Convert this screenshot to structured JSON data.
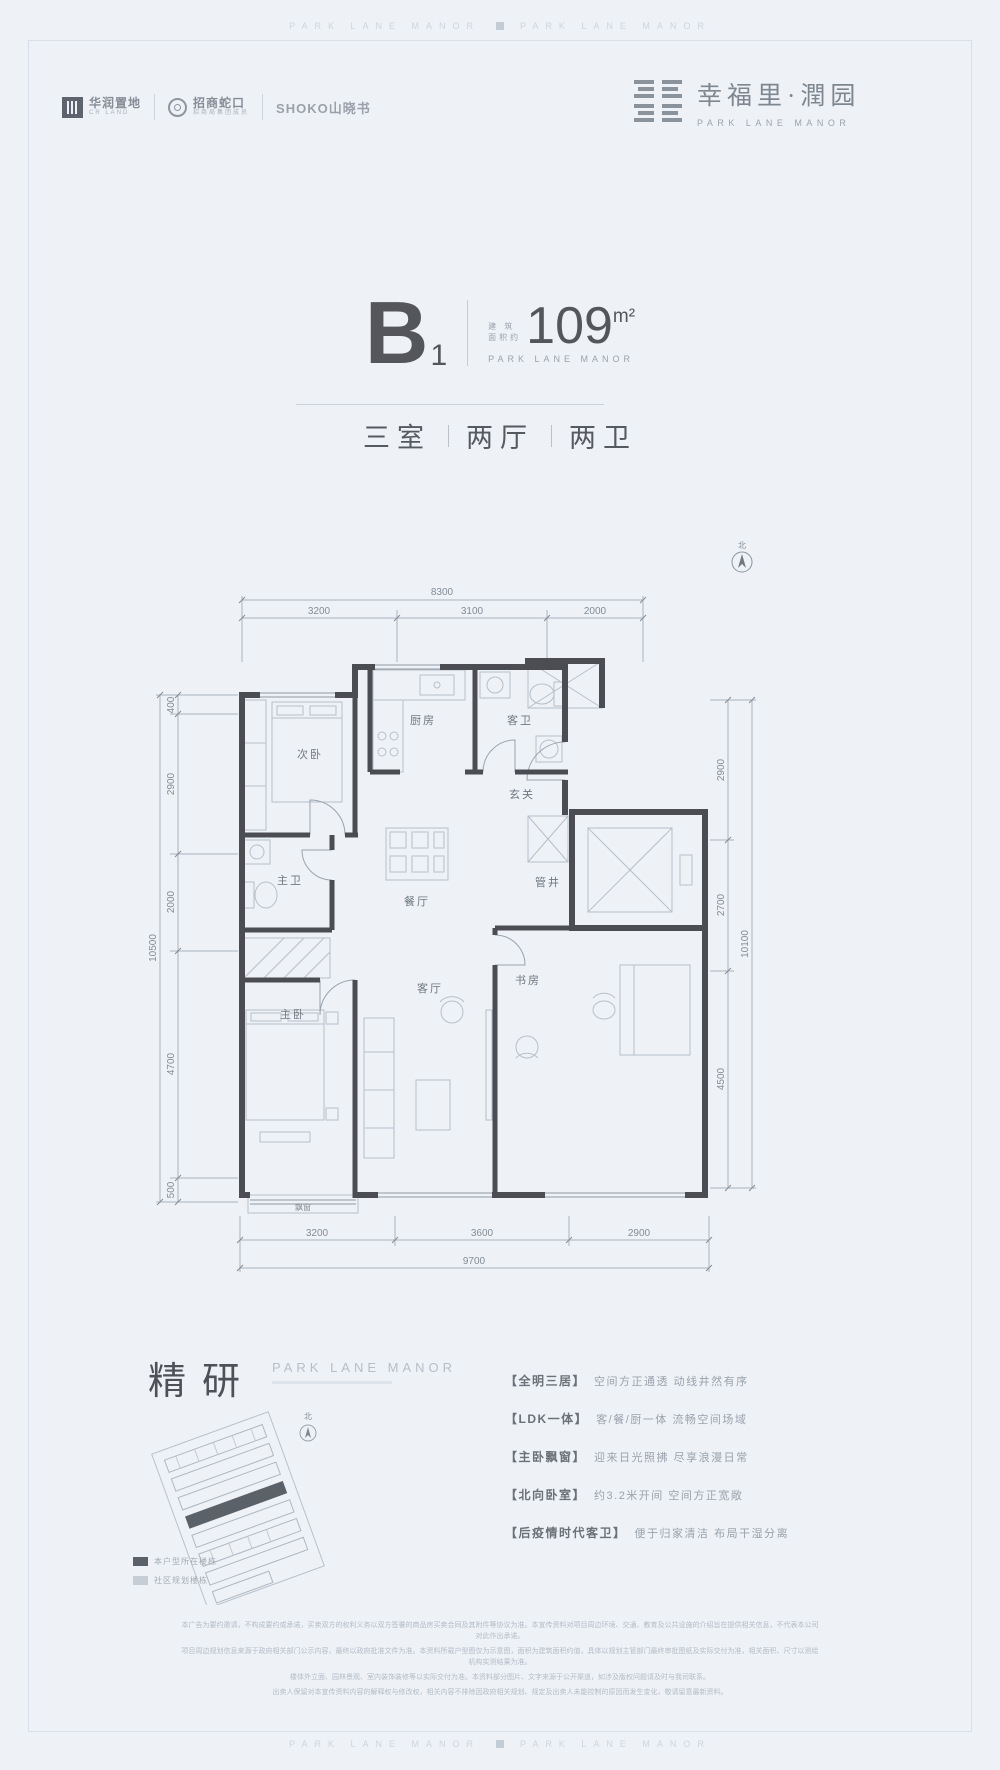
{
  "watermark": {
    "text_left": "PARK LANE MANOR",
    "text_right": "PARK LANE MANOR"
  },
  "header": {
    "logos": [
      {
        "cn": "华润置地",
        "en": "CR LAND"
      },
      {
        "cn": "招商蛇口",
        "en": "招商局集团成员"
      },
      {
        "cn": "SHOKO山晓书"
      }
    ],
    "brand": {
      "cn": "幸福里·潤园",
      "en": "PARK LANE MANOR"
    }
  },
  "unit": {
    "code": "B",
    "code_sub": "1",
    "area_label_l1": "建 筑",
    "area_label_l2": "面积约",
    "area_value": "109",
    "area_unit": "m²",
    "brand_en": "PARK LANE MANOR",
    "layout": {
      "rooms": "三室",
      "halls": "两厅",
      "baths": "两卫"
    }
  },
  "floorplan": {
    "north_label": "北",
    "dims": {
      "top_total": "8300",
      "top": [
        "3200",
        "3100",
        "2000"
      ],
      "left_total": "10500",
      "left": [
        "400",
        "2900",
        "2000",
        "4700",
        "500"
      ],
      "right_total": "10100",
      "right": [
        "2900",
        "2700",
        "4500"
      ],
      "bottom_total": "9700",
      "bottom": [
        "3200",
        "3600",
        "2900"
      ]
    },
    "rooms": {
      "second_bedroom": "次卧",
      "kitchen": "厨房",
      "guest_bath": "客卫",
      "foyer": "玄关",
      "shaft": "管井",
      "master_bath": "主卫",
      "dining": "餐厅",
      "master_bedroom": "主卧",
      "living": "客厅",
      "study": "书房",
      "bay_window": "飘窗"
    }
  },
  "refine": {
    "cn": "精研",
    "en": "PARK LANE MANOR"
  },
  "siteplan": {
    "north_label": "北"
  },
  "legend": [
    {
      "label": "本户型所在楼栋"
    },
    {
      "label": "社区规划楼栋"
    }
  ],
  "features": [
    {
      "tag": "【全明三居】",
      "desc": "空间方正通透 动线井然有序"
    },
    {
      "tag": "【LDK一体】",
      "desc": "客/餐/厨一体 流畅空间场域"
    },
    {
      "tag": "【主卧飘窗】",
      "desc": "迎来日光照拂 尽享浪漫日常"
    },
    {
      "tag": "【北向卧室】",
      "desc": "约3.2米开间 空间方正宽敞"
    },
    {
      "tag": "【后疫情时代客卫】",
      "desc": "便于归家清洁 布局干湿分离"
    }
  ],
  "disclaimer": {
    "lines": [
      "本广告为要约邀请，不构成要约或承诺，买卖双方的权利义务以双方签署的商品房买卖合同及其附件等协议为准。本宣传资料对项目周边环境、交通、教育及公共设施的介绍旨在提供相关信息，不代表本公司对此作出承诺。",
      "项目周边规划信息来源于政府相关部门公示内容，最终以政府批准文件为准。本资料所载户型图仅为示意图，面积为建筑面积约值，具体以规划主管部门最终审批图纸及实际交付为准，相关面积、尺寸以测绘机构实测结果为准。",
      "楼体外立面、园林景观、室内装饰装修等以实际交付为准。本资料部分图片、文字来源于公开渠道，如涉及版权问题请及时与我司联系。",
      "出卖人保留对本宣传资料内容的解释权与修改权，相关内容不排除因政府相关规划、规定及出卖人未能控制的原因而发生变化，敬请留意最新资料。"
    ]
  }
}
